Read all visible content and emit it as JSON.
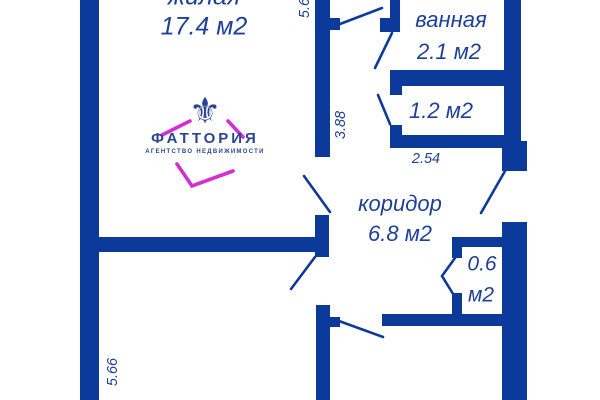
{
  "title": "Apartment floor plan",
  "colors": {
    "wall": "#0b3a9b",
    "label": "#1e4098",
    "logo_blue": "#2b4590",
    "magenta": "#d32fd4"
  },
  "rooms": {
    "living": {
      "name": "жилая",
      "area": "17.4 м2"
    },
    "bathroom": {
      "name": "ванная",
      "area": "2.1 м2"
    },
    "storage": {
      "area": "1.2 м2"
    },
    "corridor": {
      "name": "коридор",
      "area": "6.8 м2"
    },
    "closet": {
      "area_line1": "0.6",
      "area_line2": "м2"
    }
  },
  "dimensions": {
    "top_vertical": "5.6",
    "mid_vertical": "3.88",
    "storage_width": "2.54",
    "bottom_left_vertical": "5.66"
  },
  "logo": {
    "icon": "fleur-de-lis",
    "brand": "ФАТТОРИЯ",
    "tagline": "АГЕНТСТВО НЕДВИЖИМОСТИ"
  }
}
